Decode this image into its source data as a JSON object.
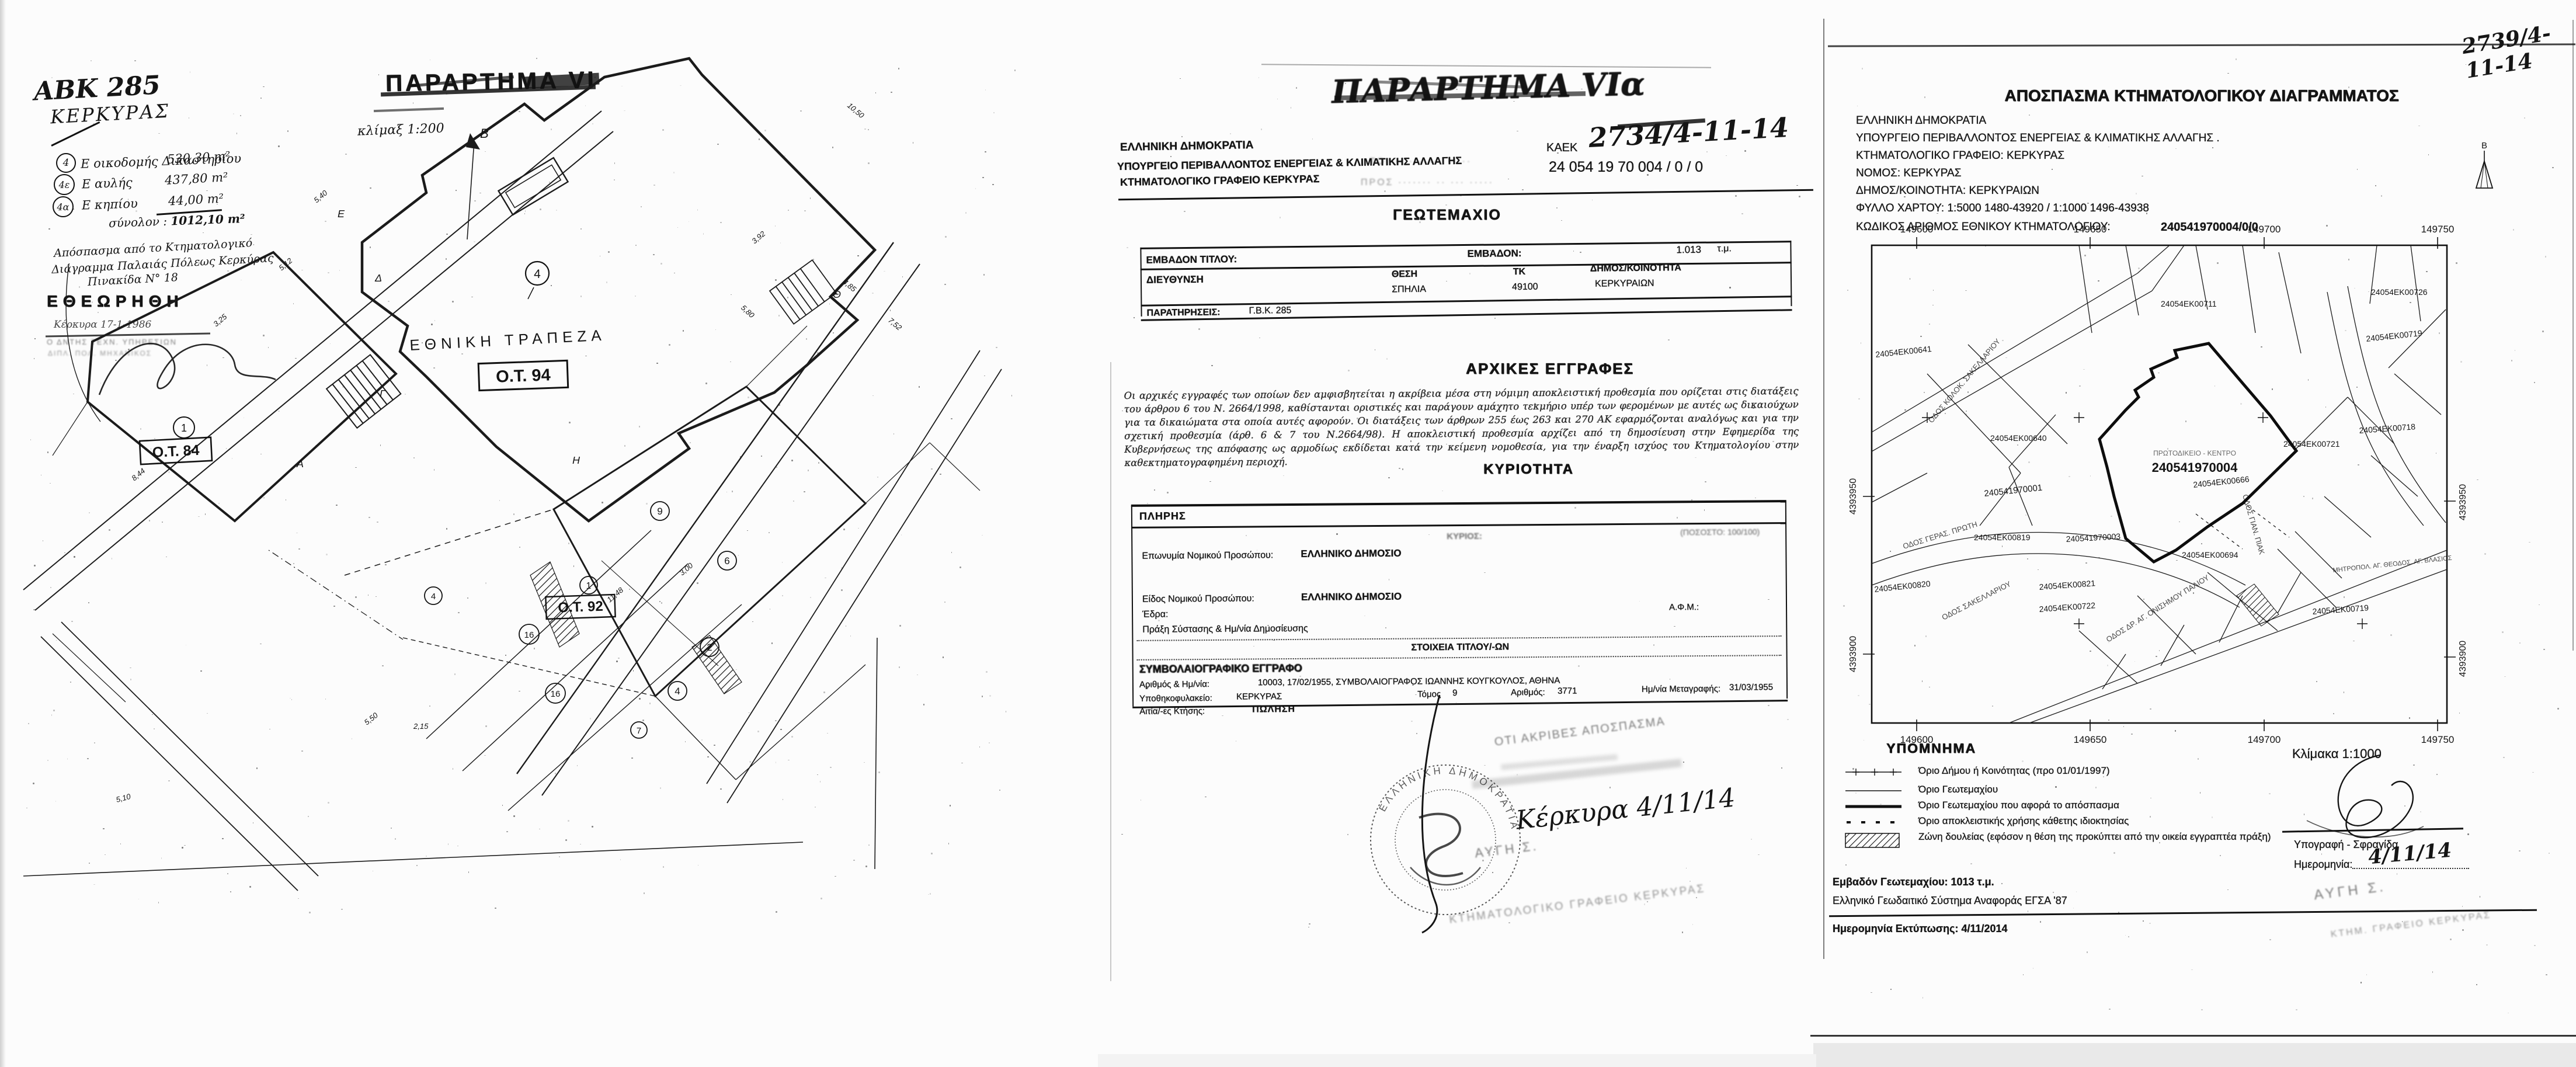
{
  "left_page": {
    "abk": "ΑΒΚ 285",
    "city": "ΚΕΡΚΥΡΑΣ",
    "title": "ΠΑΡΑΡΤΗΜΑ VI",
    "scale_note": "κλίμαξ 1:200",
    "areas": [
      {
        "marker": "4",
        "label": "Ε οικοδομής Δικαστηρίου",
        "value": "530,30 m²"
      },
      {
        "marker": "4ε",
        "label": "Ε αυλής",
        "value": "437,80 m²"
      },
      {
        "marker": "4α",
        "label": "Ε κηπίου",
        "value": "44,00 m²"
      }
    ],
    "total_label": "σύνολον :",
    "total_value": "1012,10 m²",
    "notes": [
      "Απόσπασμα από το Κτηματολογικό",
      "Διάγραμμα Παλαιάς Πόλεως Κερκύρας",
      "Πινακίδα Ν° 18"
    ],
    "stamp": {
      "title": "ΕΘΕΩΡΗΘΗ",
      "place_date": "Κέρκυρα 17-1-1986",
      "line2": "Ο ΔΝΤΗΣ ΤΕΧΝ. ΥΠΗΡΕΣΙΩΝ",
      "line3": "ΔΙΠΛ. ΠΟΛ. ΜΗΧΑΝΙΚΟΣ"
    },
    "map": {
      "north": "Β",
      "bank": "ΕΘΝΙΚΗ ΤΡΑΠΕΖΑ",
      "blocks": [
        {
          "id": "Ο.Τ. 94",
          "num": "4"
        },
        {
          "id": "Ο.Τ. 84",
          "num": "1"
        },
        {
          "id": "Ο.Τ. 92",
          "num": "1"
        }
      ],
      "circled": [
        "9",
        "6",
        "2",
        "4",
        "16",
        "16",
        "7",
        "4"
      ],
      "letters": [
        "Δ",
        "Ε",
        "Γ",
        "Θ",
        "Η",
        "Α"
      ],
      "dims": [
        "5,40",
        "5,12",
        "3,25",
        "8,44",
        "5,80",
        "10,50",
        "4,85",
        "3,92",
        "7,52",
        "5,50",
        "2,15",
        "11,48",
        "3,00",
        "5,10"
      ]
    }
  },
  "middle_page": {
    "scribble": "ΠΑΡΑΡΤΗΜΑ VIα",
    "faint_to": "ΤΟ  ···  ·······  ·····",
    "faint_pros": "ΠΡΟΣ  ·······  ··  ···  ·····",
    "agency": [
      "ΕΛΛΗΝΙΚΗ ΔΗΜΟΚΡΑΤΙΑ",
      "ΥΠΟΥΡΓΕΙΟ ΠΕΡΙΒΑΛΛΟΝΤΟΣ ΕΝΕΡΓΕΙΑΣ & ΚΛΙΜΑΤΙΚΗΣ ΑΛΛΑΓΗΣ",
      "ΚΤΗΜΑΤΟΛΟΓΙΚΟ ΓΡΑΦΕΙΟ ΚΕΡΚΥΡΑΣ"
    ],
    "kaek_label": "ΚΑΕΚ",
    "kaek_hand": "2734/4-11-14",
    "kaek_value": "24 054 19 70 004 / 0 / 0",
    "geo_title": "ΓΕΩΤΕΜΑΧΙΟ",
    "t1": {
      "area_title_label": "ΕΜΒΑΔΟΝ ΤΙΤΛΟΥ:",
      "area_label": "ΕΜΒΑΔΟΝ:",
      "area_value": "1.013",
      "area_unit": "τ.μ.",
      "address_label": "ΔΙΕΥΘΥΝΣΗ",
      "thesi_label": "ΘΕΣΗ",
      "thesi_value": "ΣΠΗΛΙΑ",
      "tk_label": "ΤΚ",
      "tk_value": "49100",
      "mun_label": "ΔΗΜΟΣ/ΚΟΙΝΟΤΗΤΑ",
      "mun_value": "ΚΕΡΚΥΡΑΙΩΝ",
      "notes_label": "ΠΑΡΑΤΗΡΗΣΕΙΣ:",
      "notes_value": "Γ.Β.Κ. 285"
    },
    "arxikes_title": "ΑΡΧΙΚΕΣ ΕΓΓΡΑΦΕΣ",
    "arxikes_text": "Οι αρχικές εγγραφές των οποίων δεν αμφισβητείται η ακρίβεια μέσα στη νόμιμη αποκλειστική προθεσμία που ορίζεται στις διατάξεις του άρθρου 6 του Ν. 2664/1998, καθίστανται οριστικές και παράγουν αμάχητο τεκμήριο υπέρ των φερομένων με αυτές ως δικαιούχων για τα δικαιώματα στα οποία αυτές αφορούν. Οι διατάξεις των άρθρων 255 έως 263 και 270 ΑΚ εφαρμόζονται αναλόγως και για την σχετική προθεσμία (άρθ. 6 & 7 του Ν.2664/98). Η αποκλειστική προθεσμία αρχίζει από τη δημοσίευση στην Εφημερίδα της Κυβερνήσεως της απόφασης ως αρμοδίως εκδίδεται κατά την κείμενη νομοθεσία, για την έναρξη ισχύος του Κτηματολογίου στην καθεκτηματογραφημένη περιοχή.",
    "kyriotita_title": "ΚΥΡΙΟΤΗΤΑ",
    "t2": {
      "plhrhs": "ΠΛΗΡΗΣ",
      "kyrios": "ΚΥΡΙΟΣ:",
      "pososto": "(ΠΟΣΟΣΤΟ: 100/100)",
      "name_label": "Επωνυμία Νομικού Προσώπου:",
      "name_value": "ΕΛΛΗΝΙΚΟ ΔΗΜΟΣΙΟ",
      "kind_label": "Είδος Νομικού Προσώπου:",
      "kind_value": "ΕΛΛΗΝΙΚΟ ΔΗΜΟΣΙΟ",
      "seat_label": "Έδρα:",
      "afm_label": "Α.Φ.Μ.:",
      "act_label": "Πράξη Σύστασης & Ημ/νία Δημοσίευσης",
      "titles_header": "ΣΤΟΙΧΕΙΑ ΤΙΤΛΟΥ/-ΩΝ",
      "doc_kind": "ΣΥΜΒΟΛΑΙΟΓΡΑΦΙΚΟ ΕΓΓΡΑΦΟ",
      "num_label": "Αριθμός & Ημ/νία:",
      "num_value": "10003, 17/02/1955, ΣΥΜΒΟΛΑΙΟΓΡΑΦΟΣ ΙΩΑΝΝΗΣ ΚΟΥΓΚΟΥΛΟΣ, ΑΘΗΝΑ",
      "reg_label": "Υποθηκοφυλακείο:",
      "reg_value": "ΚΕΡΚΥΡΑΣ",
      "tomos_label": "Τόμος",
      "tomos_value": "9",
      "num2_label": "Αριθμός:",
      "num2_value": "3771",
      "meta_label": "Ημ/νία Μεταγραφής:",
      "meta_value": "31/03/1955",
      "cause_label": "Αιτία/-ες Κτήσης:",
      "cause_value": "ΠΩΛΗΣΗ"
    },
    "cert": {
      "accurate": "ΟΤΙ ΑΚΡΙΒΕΣ ΑΠΟΣΠΑΣΜΑ",
      "hand_date": "Κέρκυρα 4/11/14",
      "faint1": "ΑΥΓΗ Σ.",
      "faint2": "ΚΤΗΜΑΤΟΛΟΓΙΚΟ ΓΡΑΦΕΙΟ ΚΕΡΚΥΡΑΣ",
      "stamp_ring": "ΕΛΛΗΝΙΚΗ ΔΗΜΟΚΡΑΤΙΑ"
    }
  },
  "right_page": {
    "ref_hand": "2739/4-11-14",
    "title": "ΑΠΟΣΠΑΣΜΑ ΚΤΗΜΑΤΟΛΟΓΙΚΟΥ ΔΙΑΓΡΑΜΜΑΤΟΣ",
    "hdr": [
      "ΕΛΛΗΝΙΚΗ ΔΗΜΟΚΡΑΤΙΑ",
      "ΥΠΟΥΡΓΕΙΟ ΠΕΡΙΒΑΛΛΟΝΤΟΣ ΕΝΕΡΓΕΙΑΣ & ΚΛΙΜΑΤΙΚΗΣ ΑΛΛΑΓΗΣ .",
      "ΚΤΗΜΑΤΟΛΟΓΙΚΟ ΓΡΑΦΕΙΟ: ΚΕΡΚΥΡΑΣ",
      "ΝΟΜΟΣ: ΚΕΡΚΥΡΑΣ",
      "ΔΗΜΟΣ/ΚΟΙΝΟΤΗΤΑ: ΚΕΡΚΥΡΑΙΩΝ",
      "ΦΥΛΛΟ ΧΑΡΤΟΥ: 1:5000 1480-43920 / 1:1000 1496-43938",
      "ΚΩΔΙΚΟΣ ΑΡΙΘΜΟΣ ΕΘΝΙΚΟΥ ΚΤΗΜΑΤΟΛΟΓΙΟΥ:"
    ],
    "kaek": "240541970004/0/0",
    "north": "Β",
    "map": {
      "xt": [
        "149600",
        "149650",
        "149700",
        "149750"
      ],
      "yt": [
        "4393950",
        "4393900"
      ],
      "focus": "240541970004",
      "focus_name": "ΠΡΩΤΟΔΙΚΕΙΟ - ΚΕΝΤΡΟ",
      "parcels": [
        "24054EK00711",
        "24054EK00726",
        "24054EK00719",
        "24054EK00640",
        "240541970001",
        "24054EK00819",
        "240541970003",
        "24054EK00666",
        "24054EK00694",
        "24054EK00721",
        "24054EK00718",
        "24054EK00821",
        "24054EK00722",
        "24054EK00719",
        "24054EK00641",
        "24054EK00820"
      ],
      "streets": [
        "ΟΔΟΣ ΚΟΛΟΚ. ΣΑΚΕΛΛΑΡΙΟΥ",
        "ΟΔΟΣ ΓΕΡΑΣ. ΠΡΩΤΗ",
        "ΟΔΟΣ ΓΙΑΝ. ΠΙΑΚ",
        "ΟΔΟΣ ΣΑΚΕΛΛΑΡΙΟΥ",
        "ΟΔΟΣ ΔΡ. ΑΓ. ΟΝΙΣΗΜΟΥ ΠΑΛΙΟΥ",
        "ΜΗΤΡΟΠΟΛ. ΑΓ. ΘΕΟΔΟΣ. ΑΓ. ΒΛΑΣΙΟΣ"
      ]
    },
    "legend": {
      "title": "ΥΠΟΜΝΗΜΑ",
      "items": [
        "Όριο Δήμου ή Κοινότητας (προ 01/01/1997)",
        "Όριο Γεωτεμαχίου",
        "Όριο Γεωτεμαχίου που αφορά το απόσπασμα",
        "Όριο αποκλειστικής χρήσης κάθετης ιδιοκτησίας",
        "Ζώνη δουλείας (εφόσον η θέση της προκύπτει από την οικεία εγγραπτέα πράξη)"
      ]
    },
    "scale": "Κλίμακα 1:1000",
    "sig_label": "Υπογραφή - Σφραγίδα",
    "date_label": "Ημερομηνία:",
    "date_hand": "4/11/14",
    "area_line": "Εμβαδόν Γεωτεμαχίου: 1013 τ.μ.",
    "datum_line": "Ελληνικό Γεωδαιτικό Σύστημα Αναφοράς ΕΓΣΑ '87",
    "print_line": "Ημερομηνία Εκτύπωσης: 4/11/2014",
    "stamp1": "ΑΥΓΗ Σ.",
    "stamp2": "ΚΤΗΜ. ΓΡΑΦΕΙΟ ΚΕΡΚΥΡΑΣ"
  }
}
